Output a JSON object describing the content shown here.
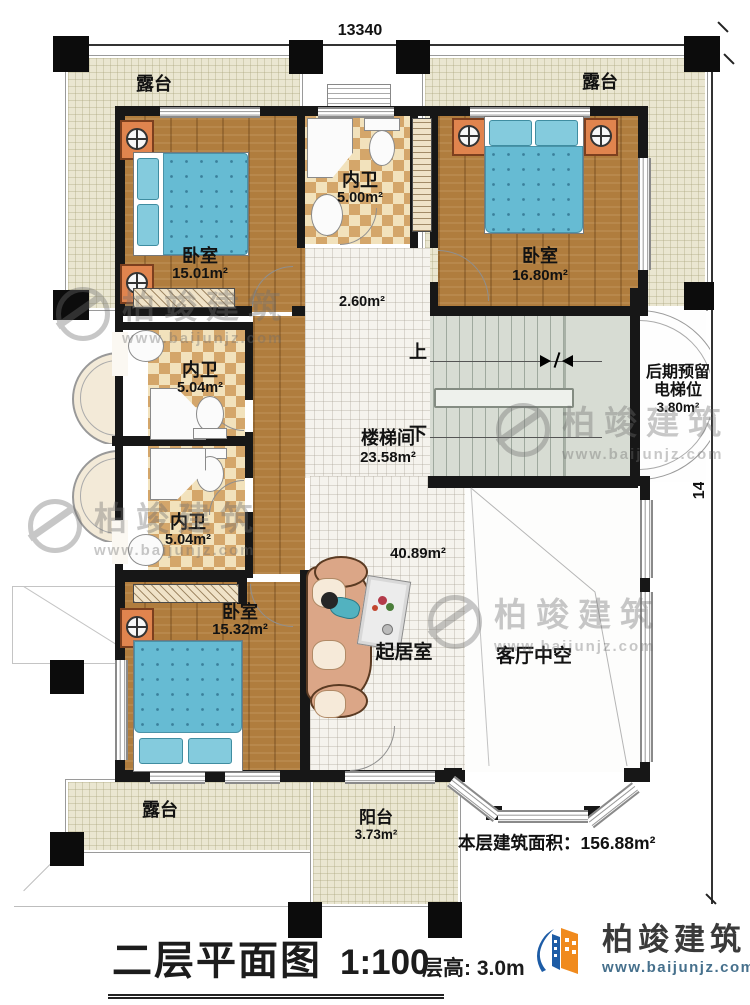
{
  "plan": {
    "dim_top": "13340",
    "dim_right": "14940",
    "up": "上",
    "down": "下"
  },
  "rooms": {
    "terrace_tl": "露台",
    "terrace_tr": "露台",
    "terrace_b": "露台",
    "balcony": {
      "name": "阳台",
      "area": "3.73m²"
    },
    "bedroom_tl": {
      "name": "卧室",
      "area": "15.01m²"
    },
    "bedroom_tr": {
      "name": "卧室",
      "area": "16.80m²"
    },
    "bedroom_b": {
      "name": "卧室",
      "area": "15.32m²"
    },
    "bath_top": {
      "name": "内卫",
      "area": "5.00m²"
    },
    "bath_mid": {
      "name": "内卫",
      "area": "5.04m²"
    },
    "bath_low": {
      "name": "内卫",
      "area": "5.04m²"
    },
    "hall_area": "2.60m²",
    "stairwell": {
      "name": "楼梯间",
      "area": "23.58m²"
    },
    "elevator": {
      "line1": "后期预留",
      "line2": "电梯位",
      "area": "3.80m²"
    },
    "living": {
      "name": "起居室",
      "area": "40.89m²"
    },
    "void_name": "客厅中空"
  },
  "notes": {
    "area_label": "本层建筑面积：",
    "area_value": "156.88m²"
  },
  "title_block": {
    "title": "二层平面图",
    "scale": "1:100",
    "floor_height": "层高: 3.0m"
  },
  "brand": {
    "name": "柏竣建筑",
    "website": "www.baijunjz.com"
  },
  "watermark": {
    "name": "柏竣建筑",
    "website": "www.baijunjz.com"
  },
  "colors": {
    "wall": "#171717",
    "terrace": "#eae6d1",
    "wood": "#b07d3e",
    "checker": "#d4a66a",
    "bed_blue": "#66bbd3",
    "stair": "#d7dcd3",
    "accent_orange": "#e0844e",
    "logo_blue": "#1d5ca6",
    "logo_orange": "#f08a1d"
  }
}
